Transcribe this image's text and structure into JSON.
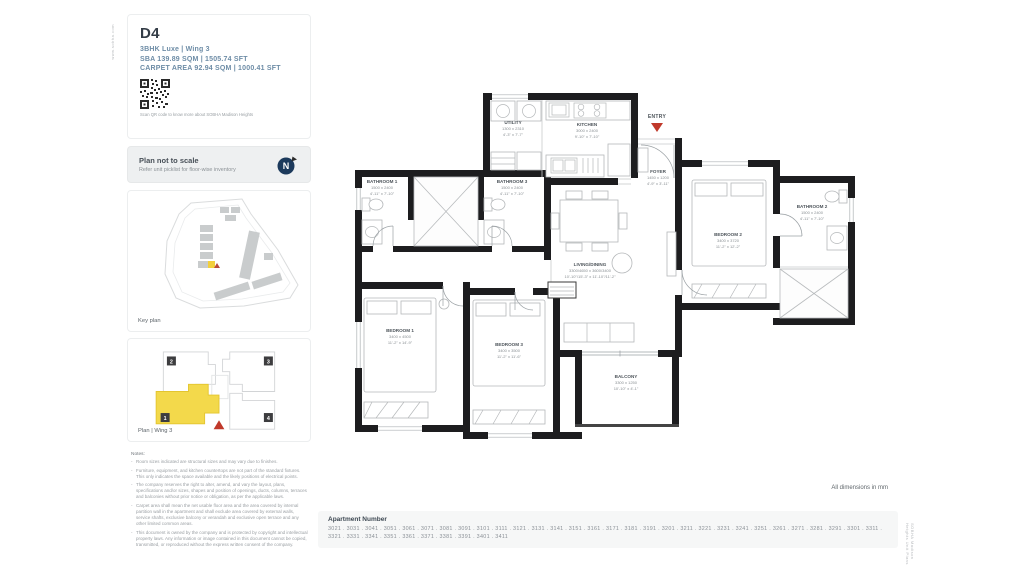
{
  "page": {
    "left_edge_text": "www.sobha.com",
    "right_edge_text": "SOBHA Madison Heights Unit Plans"
  },
  "header": {
    "unit_code": "D4",
    "unit_type": "3BHK Luxe | Wing 3",
    "sba": "SBA 139.89 SQM | 1505.74 SFT",
    "carpet_area": "CARPET AREA 92.94 SQM | 1000.41 SFT",
    "qr_caption": "Scan QR code to know more about SOBHA Madison Heights"
  },
  "plan_note": {
    "title": "Plan not to scale",
    "subtitle": "Refer unit picklist for floor-wise inventory",
    "compass_letter": "N"
  },
  "key_plan": {
    "label": "Key plan"
  },
  "wing_plan": {
    "label": "Plan | Wing 3",
    "units": [
      "2",
      "3",
      "1",
      "4"
    ],
    "highlight_color": "#f3d94b",
    "marker_color": "#c0392b"
  },
  "notes": {
    "title": "Notes:",
    "items": [
      "Room sizes indicated are structural sizes and may vary due to finishes.",
      "Furniture, equipment, and kitchen countertops are not part of the standard fixtures. This only indicates the space available and the likely positions of electrical points.",
      "The company reserves the right to alter, amend, and vary the layout, plans, specifications and/or sizes, shapes and position of openings, ducts, columns, terraces and balconies without prior notice or obligation, as per the applicable laws.",
      "Carpet area shall mean the net usable floor area and the area covered by internal partition wall in the apartment and shall exclude area covered by external walls, service shafts, exclusive balcony or verandah and exclusive open terrace and any other limited common areas.",
      "This document is owned by the company and is protected by copyright and intellectual property laws. Any information or image contained in this document cannot be copied, transmitted, or reproduced without the express written consent of the company."
    ]
  },
  "floor_plan": {
    "dimensions_note": "All dimensions in mm",
    "entry_label": "ENTRY",
    "wall_color": "#1d1d1f",
    "rooms": [
      {
        "name": "UTILITY",
        "metric": "1300 x 2310",
        "imperial": "4'-3\" x 7'-7\""
      },
      {
        "name": "KITCHEN",
        "metric": "3000 x 2400",
        "imperial": "9'-10\" x 7'-10\""
      },
      {
        "name": "FOYER",
        "metric": "1450 x 1200",
        "imperial": "4'-9\" x 3'-11\""
      },
      {
        "name": "BATHROOM 1",
        "metric": "1500 x 2400",
        "imperial": "4'-11\" x 7'-10\""
      },
      {
        "name": "BATHROOM 3",
        "metric": "1500 x 2400",
        "imperial": "4'-11\" x 7'-10\""
      },
      {
        "name": "BATHROOM 2",
        "metric": "1500 x 2400",
        "imperial": "4'-11\" x 7'-10\""
      },
      {
        "name": "BEDROOM 2",
        "metric": "3400 x 3720",
        "imperial": "11'-2\" x 12'-2\""
      },
      {
        "name": "LIVING/DINING",
        "metric": "3300/4650 x 3600/3400",
        "imperial": "10'-10\"/15'-3\" x 11'-10\"/11'-2\""
      },
      {
        "name": "BEDROOM 1",
        "metric": "3400 x 4500",
        "imperial": "11'-2\" x 14'-9\""
      },
      {
        "name": "BEDROOM 3",
        "metric": "3400 x 3500",
        "imperial": "11'-2\" x 11'-6\""
      },
      {
        "name": "BALCONY",
        "metric": "3300 x 1250",
        "imperial": "10'-10\" x 4'-1\""
      }
    ]
  },
  "apartment_numbers": {
    "title": "Apartment Number",
    "numbers": [
      "3021",
      "3031",
      "3041",
      "3051",
      "3061",
      "3071",
      "3081",
      "3091",
      "3101",
      "3111",
      "3121",
      "3131",
      "3141",
      "3151",
      "3161",
      "3171",
      "3181",
      "3191",
      "3201",
      "3211",
      "3221",
      "3231",
      "3241",
      "3251",
      "3261",
      "3271",
      "3281",
      "3291",
      "3301",
      "3311",
      "3321",
      "3331",
      "3341",
      "3351",
      "3361",
      "3371",
      "3381",
      "3391",
      "3401",
      "3411"
    ]
  }
}
